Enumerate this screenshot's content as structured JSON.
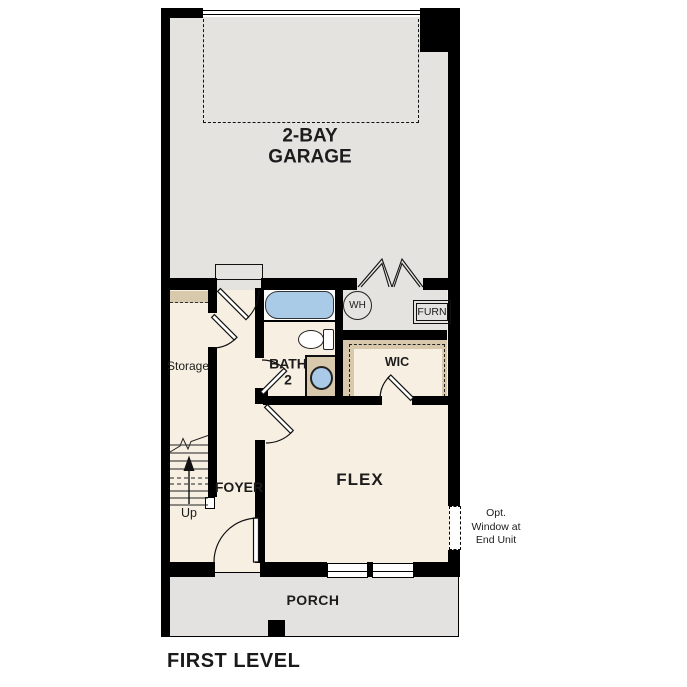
{
  "title": "FIRST LEVEL",
  "rooms": {
    "garage": {
      "line1": "2-BAY",
      "line2": "GARAGE"
    },
    "storage": {
      "label": "Storage"
    },
    "bath": {
      "line1": "BATH",
      "line2": "2"
    },
    "wic": {
      "label": "WIC"
    },
    "foyer": {
      "label": "FOYER"
    },
    "flex": {
      "label": "FLEX"
    },
    "porch": {
      "label": "PORCH"
    }
  },
  "equipment": {
    "water_heater": "WH",
    "furnace": "FURN"
  },
  "stairs": {
    "direction": "Up"
  },
  "annotation": {
    "line1": "Opt.",
    "line2": "Window at",
    "line3": "End Unit"
  },
  "colors": {
    "wall": "#000000",
    "line": "#1a1a1a",
    "floor-interior": "#f7efe1",
    "floor-garage": "#e4e3e0",
    "floor-porch": "#e3e2e0",
    "casework": "#d8c9ad",
    "fixture-blue": "#a9cbe8",
    "text": "#1c1c1c"
  }
}
